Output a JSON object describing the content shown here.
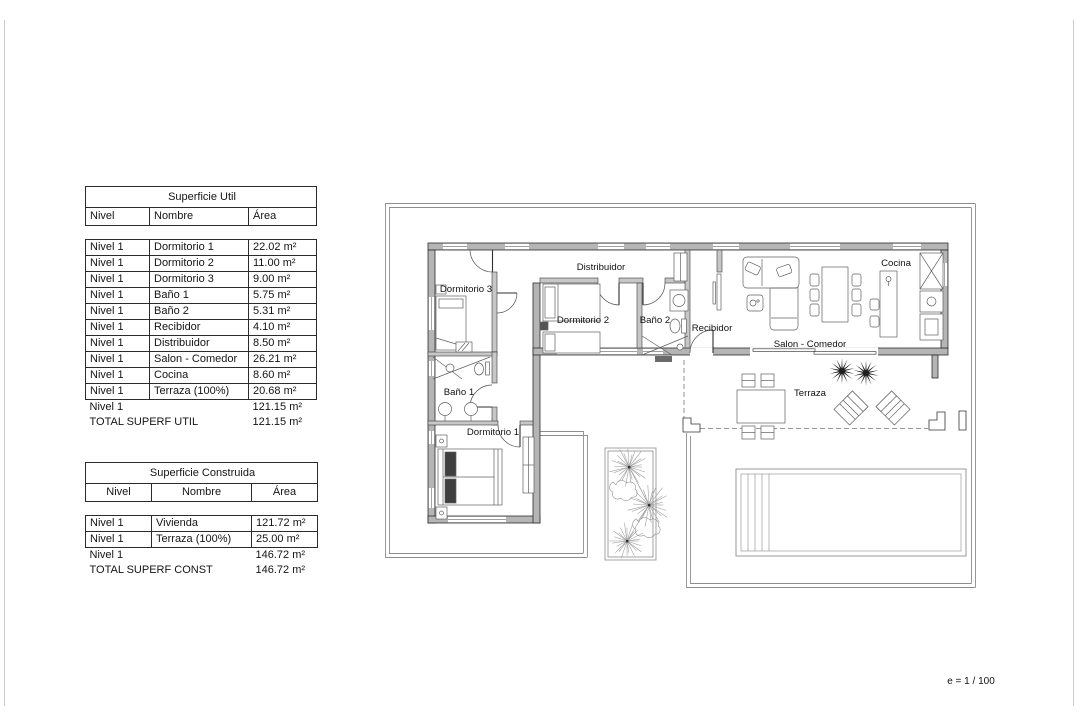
{
  "page": {
    "scale_note": "e = 1 / 100"
  },
  "tables": {
    "superficie_util": {
      "title": "Superficie Util",
      "headers": {
        "nivel": "Nivel",
        "nombre": "Nombre",
        "area": "Área"
      },
      "rows": [
        {
          "nivel": "Nivel 1",
          "nombre": "Dormitorio 1",
          "area": "22.02 m²"
        },
        {
          "nivel": "Nivel 1",
          "nombre": "Dormitorio 2",
          "area": "11.00 m²"
        },
        {
          "nivel": "Nivel 1",
          "nombre": "Dormitorio 3",
          "area": "9.00 m²"
        },
        {
          "nivel": "Nivel 1",
          "nombre": "Baño 1",
          "area": "5.75 m²"
        },
        {
          "nivel": "Nivel 1",
          "nombre": "Baño 2",
          "area": "5.31 m²"
        },
        {
          "nivel": "Nivel 1",
          "nombre": "Recibidor",
          "area": "4.10 m²"
        },
        {
          "nivel": "Nivel 1",
          "nombre": "Distribuidor",
          "area": "8.50 m²"
        },
        {
          "nivel": "Nivel 1",
          "nombre": "Salon - Comedor",
          "area": "26.21 m²"
        },
        {
          "nivel": "Nivel 1",
          "nombre": "Cocina",
          "area": "8.60 m²"
        },
        {
          "nivel": "Nivel 1",
          "nombre": "Terraza (100%)",
          "area": "20.68 m²"
        }
      ],
      "subtotal": {
        "nivel": "Nivel 1",
        "area": "121.15 m²"
      },
      "total": {
        "label": "TOTAL SUPERF UTIL",
        "area": "121.15 m²"
      }
    },
    "superficie_construida": {
      "title": "Superficie Construida",
      "headers": {
        "nivel": "Nivel",
        "nombre": "Nombre",
        "area": "Área"
      },
      "rows": [
        {
          "nivel": "Nivel 1",
          "nombre": "Vivienda",
          "area": "121.72 m²"
        },
        {
          "nivel": "Nivel 1",
          "nombre": "Terraza (100%)",
          "area": "25.00 m²"
        }
      ],
      "subtotal": {
        "nivel": "Nivel 1",
        "area": "146.72 m²"
      },
      "total": {
        "label": "TOTAL SUPERF CONST",
        "area": "146.72 m²"
      }
    }
  },
  "plan": {
    "labels": {
      "distribuidor": "Distribuidor",
      "dormitorio3": "Dormitorio 3",
      "dormitorio2": "Dormitorio 2",
      "bano2": "Baño 2",
      "recibidor": "Recibidor",
      "salon_comedor": "Salon - Comedor",
      "cocina": "Cocina",
      "bano1": "Baño 1",
      "dormitorio1": "Dormitorio 1",
      "terraza": "Terraza"
    }
  }
}
